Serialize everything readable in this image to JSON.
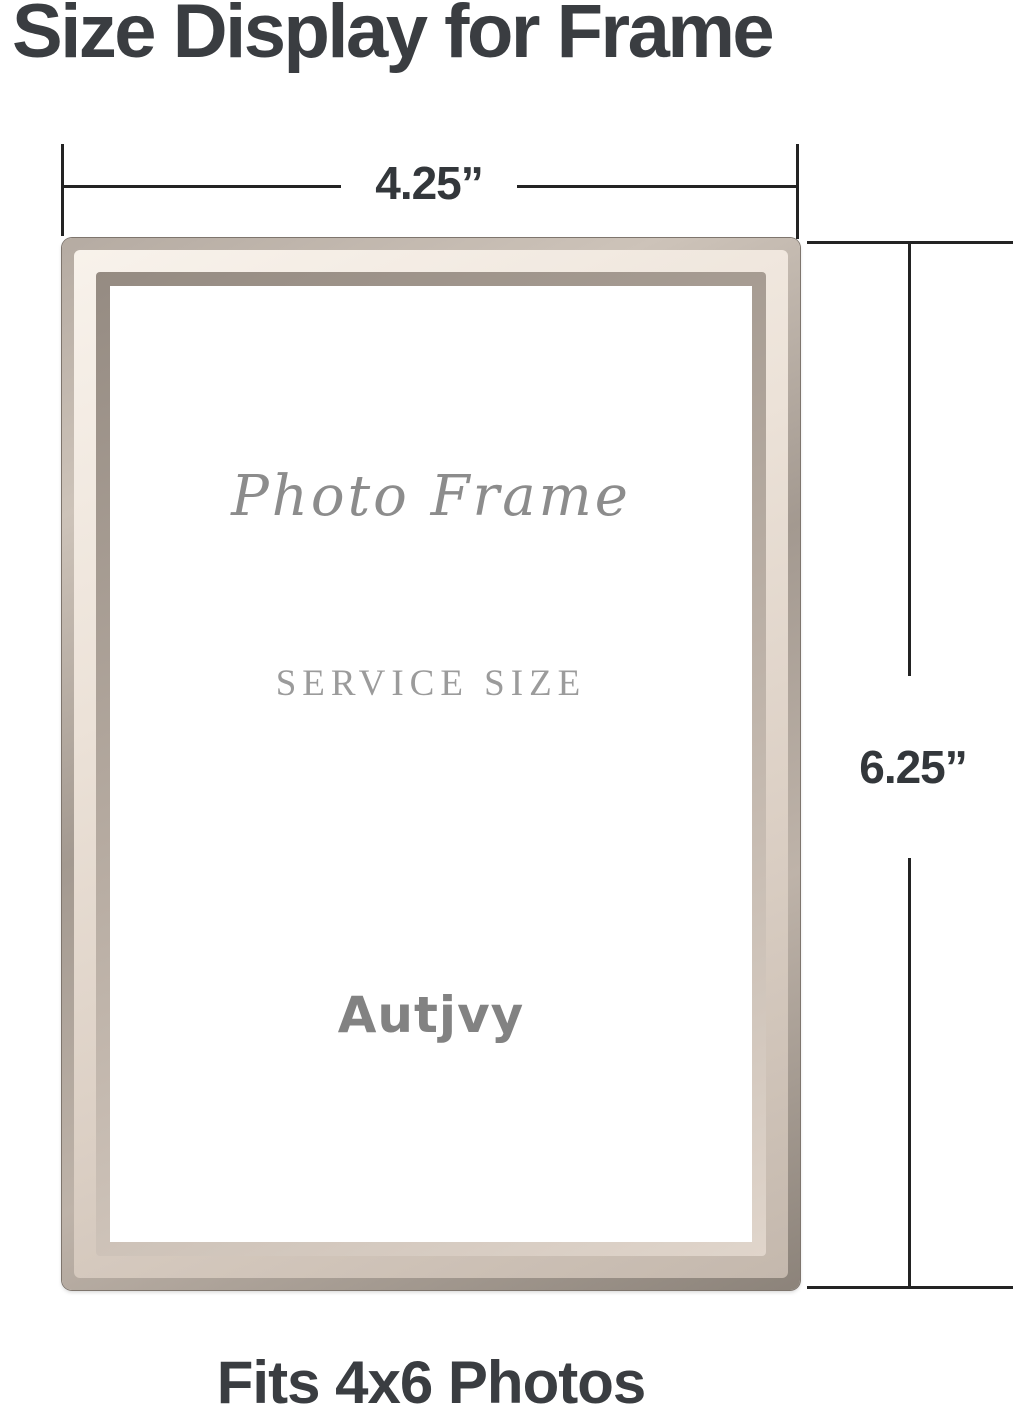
{
  "title": "Size Display for Frame",
  "caption": "Fits 4x6 Photos",
  "dimensions": {
    "width_label": "4.25”",
    "height_label": "6.25”"
  },
  "frame": {
    "script_text": "Photo Frame",
    "service_text": "SERVICE SIZE",
    "brand": "Autjvy"
  },
  "colors": {
    "headline_text": "#3a3d41",
    "dimension_line": "#232323",
    "frame_highlight": "#f8f2eb",
    "frame_mid": "#d8ccc2",
    "frame_edge": "#8c837a",
    "insert_text_gray": "#8c8c8c"
  }
}
